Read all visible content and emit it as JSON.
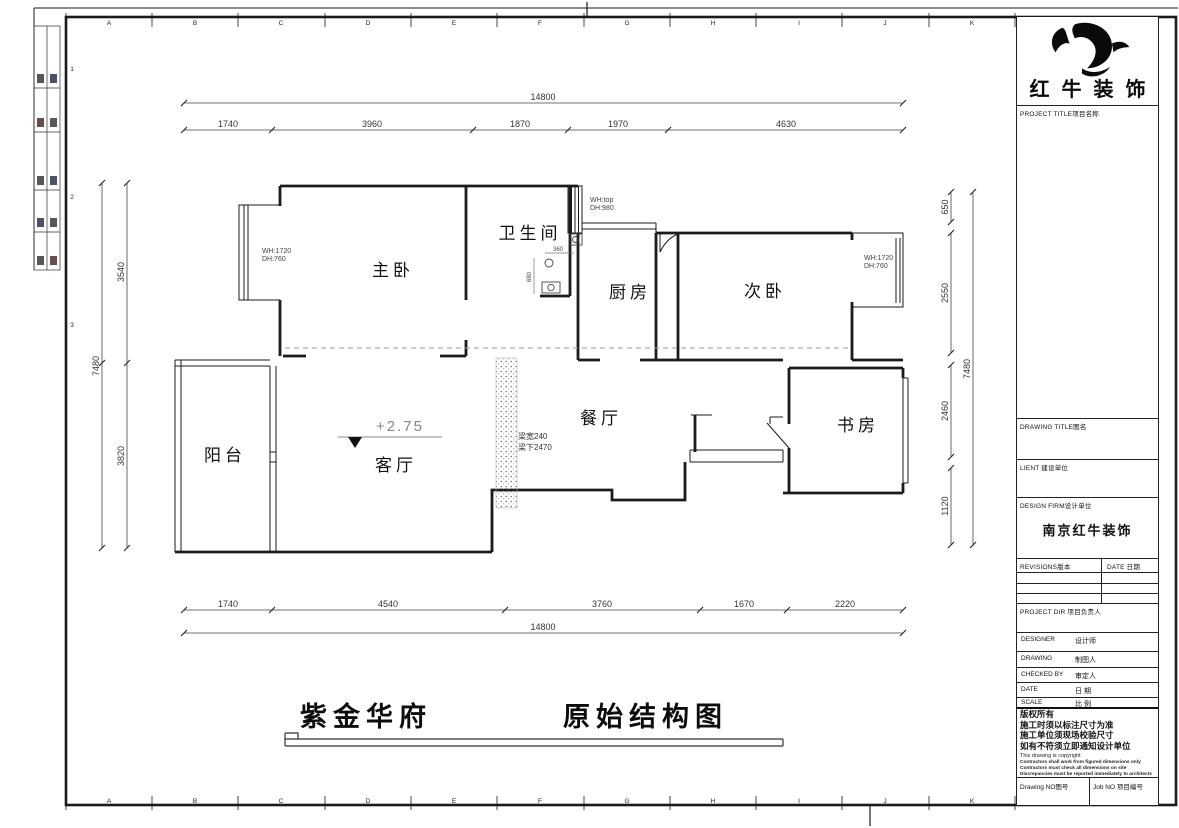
{
  "frame": {
    "grid_letters": [
      "A",
      "B",
      "C",
      "D",
      "E",
      "F",
      "G",
      "H",
      "I",
      "J",
      "K"
    ],
    "grid_numbers": [
      "1",
      "2",
      "3"
    ]
  },
  "plan": {
    "rooms": [
      "主卧",
      "卫生间",
      "厨房",
      "次卧",
      "阳台",
      "客厅",
      "餐厅",
      "书房"
    ],
    "level_mark": "+2.75",
    "beam_width_note": "梁宽240",
    "beam_bottom_note": "梁下2470",
    "window_notes": [
      {
        "l1": "WH:1720",
        "l2": "DH:760"
      },
      {
        "l1": "WH:top",
        "l2": "DH:980"
      },
      {
        "l1": "WH:1720",
        "l2": "DH:760"
      }
    ],
    "bath_dim_h": "360",
    "bath_dim_v": "680",
    "dims": {
      "top_total": "14800",
      "top_segments": [
        "1740",
        "3960",
        "1870",
        "1970",
        "4630"
      ],
      "bottom_segments": [
        "1740",
        "4540",
        "3760",
        "1670",
        "2220"
      ],
      "bottom_total": "14800",
      "left_total": "7480",
      "left_segments": [
        "3540",
        "3820"
      ],
      "right_segments": [
        "650",
        "2550",
        "2460",
        "1120"
      ],
      "right_total": "7480"
    }
  },
  "title": {
    "project": "紫金华府",
    "drawing": "原始结构图"
  },
  "titleblock": {
    "company": "红牛装饰",
    "project_title_label": "PROJECT TITLE项目名称",
    "drawing_title_label": "DRAWING TITLE图名",
    "client_label": "LIENT 建设单位",
    "design_firm_label": "DESIGN FIRM设计单位",
    "design_firm_value": "南京红牛装饰",
    "revisions_label": "REVISIONS版本",
    "revisions_date_label": "DATE 日期",
    "project_dir_label": "PROJECT DIR 项目负责人",
    "rows": [
      {
        "en": "DESIGNER",
        "cn": "设计师"
      },
      {
        "en": "DRAWING",
        "cn": "制图人"
      },
      {
        "en": "CHECKED BY",
        "cn": "审定人"
      },
      {
        "en": "DATE",
        "cn": "日 期"
      },
      {
        "en": "SCALE",
        "cn": "比 例"
      }
    ],
    "copyright_cn": [
      "版权所有",
      "施工时须以标注尺寸为准",
      "施工单位须现场校验尺寸",
      "如有不符须立即通知设计单位"
    ],
    "copyright_en": [
      "This drawing is copyright",
      "Contractors shall work from figured dimensions only",
      "Contractors must check all dimensions on site",
      "Discrepancies must be reported immediately to architects"
    ],
    "drawing_no_label": "Drawing NO图号",
    "job_no_label": "Job NO 项目编号"
  }
}
